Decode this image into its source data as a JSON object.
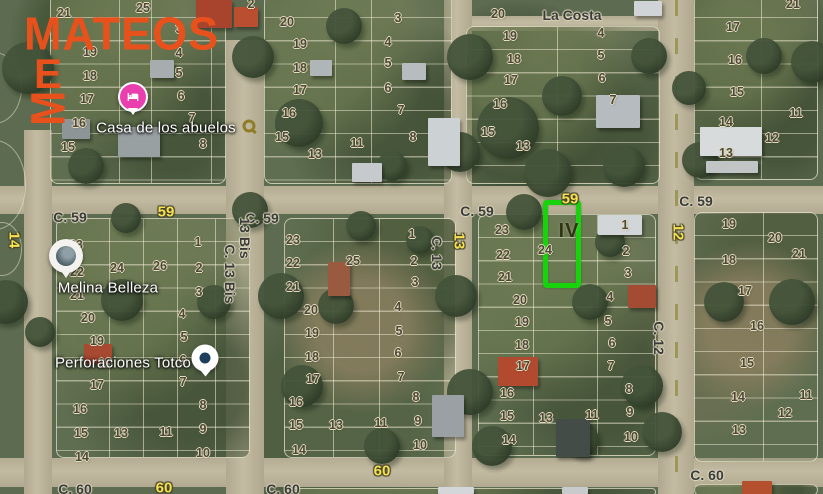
{
  "brand": {
    "name": "MATEOS",
    "color": "#e8511c",
    "mark_letters": [
      "E",
      "M"
    ]
  },
  "map": {
    "street_names": [
      {
        "t": "La Costa",
        "x": 572,
        "y": 15
      },
      {
        "t": "C. 59",
        "x": 70,
        "y": 217
      },
      {
        "t": "C. 59",
        "x": 262,
        "y": 218
      },
      {
        "t": "C. 59",
        "x": 477,
        "y": 211
      },
      {
        "t": "C. 59",
        "x": 696,
        "y": 201
      },
      {
        "t": "C. 60",
        "x": 75,
        "y": 489
      },
      {
        "t": "C. 60",
        "x": 283,
        "y": 489
      },
      {
        "t": "C. 60",
        "x": 707,
        "y": 475
      },
      {
        "t": "13 Bis",
        "x": 245,
        "y": 238,
        "v": 1
      },
      {
        "t": "C. 13 Bis",
        "x": 230,
        "y": 274,
        "v": 1
      },
      {
        "t": "C. 13",
        "x": 437,
        "y": 253,
        "v": 1
      },
      {
        "t": "C. 12",
        "x": 659,
        "y": 338,
        "v": 1
      }
    ],
    "route_badges": [
      {
        "t": "59",
        "x": 166,
        "y": 212
      },
      {
        "t": "59",
        "x": 570,
        "y": 199
      },
      {
        "t": "60",
        "x": 164,
        "y": 488
      },
      {
        "t": "60",
        "x": 382,
        "y": 471
      },
      {
        "t": "14",
        "x": 14,
        "y": 240,
        "v": 1
      },
      {
        "t": "13",
        "x": 459,
        "y": 241,
        "v": 1
      },
      {
        "t": "12",
        "x": 678,
        "y": 232,
        "v": 1
      }
    ],
    "blocks": [
      {
        "id": "northwest",
        "lots": [
          {
            "t": "21",
            "x": 64,
            "y": 13
          },
          {
            "t": "25",
            "x": 143,
            "y": 8
          },
          {
            "t": "2",
            "x": 251,
            "y": 4
          },
          {
            "t": "19",
            "x": 90,
            "y": 52
          },
          {
            "t": "18",
            "x": 90,
            "y": 76
          },
          {
            "t": "17",
            "x": 87,
            "y": 99
          },
          {
            "t": "16",
            "x": 79,
            "y": 123
          },
          {
            "t": "15",
            "x": 68,
            "y": 147
          },
          {
            "t": "3",
            "x": 179,
            "y": 29
          },
          {
            "t": "4",
            "x": 179,
            "y": 53
          },
          {
            "t": "5",
            "x": 179,
            "y": 73
          },
          {
            "t": "6",
            "x": 181,
            "y": 96
          },
          {
            "t": "7",
            "x": 192,
            "y": 118
          },
          {
            "t": "8",
            "x": 203,
            "y": 144
          }
        ]
      },
      {
        "id": "north-middle",
        "lots": [
          {
            "t": "20",
            "x": 287,
            "y": 22
          },
          {
            "t": "19",
            "x": 300,
            "y": 44
          },
          {
            "t": "18",
            "x": 300,
            "y": 68
          },
          {
            "t": "17",
            "x": 300,
            "y": 90
          },
          {
            "t": "16",
            "x": 289,
            "y": 113
          },
          {
            "t": "15",
            "x": 282,
            "y": 137
          },
          {
            "t": "13",
            "x": 315,
            "y": 154
          },
          {
            "t": "3",
            "x": 398,
            "y": 18
          },
          {
            "t": "4",
            "x": 388,
            "y": 42
          },
          {
            "t": "5",
            "x": 388,
            "y": 63
          },
          {
            "t": "6",
            "x": 388,
            "y": 88
          },
          {
            "t": "7",
            "x": 401,
            "y": 110
          },
          {
            "t": "8",
            "x": 413,
            "y": 137
          },
          {
            "t": "11",
            "x": 357,
            "y": 143
          }
        ]
      },
      {
        "id": "northeast",
        "lots": [
          {
            "t": "20",
            "x": 498,
            "y": 14
          },
          {
            "t": "19",
            "x": 510,
            "y": 36
          },
          {
            "t": "18",
            "x": 514,
            "y": 59
          },
          {
            "t": "17",
            "x": 511,
            "y": 80
          },
          {
            "t": "16",
            "x": 500,
            "y": 104
          },
          {
            "t": "15",
            "x": 488,
            "y": 132
          },
          {
            "t": "13",
            "x": 523,
            "y": 146
          },
          {
            "t": "4",
            "x": 601,
            "y": 33
          },
          {
            "t": "5",
            "x": 601,
            "y": 55
          },
          {
            "t": "6",
            "x": 602,
            "y": 78
          },
          {
            "t": "7",
            "x": 613,
            "y": 100
          }
        ]
      },
      {
        "id": "far-northeast",
        "lots": [
          {
            "t": "21",
            "x": 793,
            "y": 4
          },
          {
            "t": "17",
            "x": 733,
            "y": 27
          },
          {
            "t": "16",
            "x": 735,
            "y": 60
          },
          {
            "t": "15",
            "x": 737,
            "y": 92
          },
          {
            "t": "14",
            "x": 726,
            "y": 122
          },
          {
            "t": "13",
            "x": 726,
            "y": 153
          },
          {
            "t": "11",
            "x": 796,
            "y": 113
          },
          {
            "t": "12",
            "x": 772,
            "y": 138
          }
        ]
      },
      {
        "id": "west-middle",
        "lots": [
          {
            "t": "23",
            "x": 76,
            "y": 245
          },
          {
            "t": "22",
            "x": 77,
            "y": 272
          },
          {
            "t": "21",
            "x": 77,
            "y": 295
          },
          {
            "t": "20",
            "x": 88,
            "y": 318
          },
          {
            "t": "19",
            "x": 97,
            "y": 341
          },
          {
            "t": "18",
            "x": 105,
            "y": 363
          },
          {
            "t": "17",
            "x": 97,
            "y": 385
          },
          {
            "t": "16",
            "x": 80,
            "y": 409
          },
          {
            "t": "15",
            "x": 81,
            "y": 433
          },
          {
            "t": "14",
            "x": 82,
            "y": 457
          },
          {
            "t": "24",
            "x": 117,
            "y": 268
          },
          {
            "t": "26",
            "x": 160,
            "y": 266
          },
          {
            "t": "13",
            "x": 121,
            "y": 433
          },
          {
            "t": "11",
            "x": 166,
            "y": 432
          },
          {
            "t": "1",
            "x": 198,
            "y": 242
          },
          {
            "t": "2",
            "x": 199,
            "y": 268
          },
          {
            "t": "3",
            "x": 199,
            "y": 292
          },
          {
            "t": "4",
            "x": 182,
            "y": 314
          },
          {
            "t": "5",
            "x": 184,
            "y": 337
          },
          {
            "t": "6",
            "x": 183,
            "y": 360
          },
          {
            "t": "7",
            "x": 183,
            "y": 382
          },
          {
            "t": "8",
            "x": 203,
            "y": 405
          },
          {
            "t": "9",
            "x": 203,
            "y": 429
          },
          {
            "t": "10",
            "x": 203,
            "y": 453
          }
        ]
      },
      {
        "id": "middle",
        "lots": [
          {
            "t": "23",
            "x": 293,
            "y": 240
          },
          {
            "t": "22",
            "x": 293,
            "y": 263
          },
          {
            "t": "21",
            "x": 293,
            "y": 287
          },
          {
            "t": "20",
            "x": 311,
            "y": 310
          },
          {
            "t": "19",
            "x": 312,
            "y": 333
          },
          {
            "t": "18",
            "x": 312,
            "y": 357
          },
          {
            "t": "17",
            "x": 313,
            "y": 379
          },
          {
            "t": "16",
            "x": 296,
            "y": 402
          },
          {
            "t": "15",
            "x": 296,
            "y": 425
          },
          {
            "t": "14",
            "x": 299,
            "y": 450
          },
          {
            "t": "25",
            "x": 353,
            "y": 261
          },
          {
            "t": "13",
            "x": 336,
            "y": 425
          },
          {
            "t": "11",
            "x": 381,
            "y": 423
          },
          {
            "t": "1",
            "x": 412,
            "y": 234
          },
          {
            "t": "2",
            "x": 414,
            "y": 261
          },
          {
            "t": "3",
            "x": 415,
            "y": 282
          },
          {
            "t": "4",
            "x": 398,
            "y": 307
          },
          {
            "t": "5",
            "x": 399,
            "y": 331
          },
          {
            "t": "6",
            "x": 398,
            "y": 353
          },
          {
            "t": "7",
            "x": 401,
            "y": 377
          },
          {
            "t": "8",
            "x": 416,
            "y": 397
          },
          {
            "t": "9",
            "x": 418,
            "y": 421
          },
          {
            "t": "10",
            "x": 420,
            "y": 445
          }
        ]
      },
      {
        "id": "east-middle",
        "lots": [
          {
            "t": "23",
            "x": 502,
            "y": 230
          },
          {
            "t": "22",
            "x": 503,
            "y": 255
          },
          {
            "t": "21",
            "x": 505,
            "y": 277
          },
          {
            "t": "20",
            "x": 520,
            "y": 300
          },
          {
            "t": "19",
            "x": 522,
            "y": 322
          },
          {
            "t": "18",
            "x": 522,
            "y": 345
          },
          {
            "t": "17",
            "x": 523,
            "y": 366
          },
          {
            "t": "16",
            "x": 507,
            "y": 393
          },
          {
            "t": "15",
            "x": 507,
            "y": 416
          },
          {
            "t": "14",
            "x": 509,
            "y": 440
          },
          {
            "t": "24",
            "x": 545,
            "y": 250
          },
          {
            "t": "13",
            "x": 546,
            "y": 418
          },
          {
            "t": "11",
            "x": 592,
            "y": 415
          },
          {
            "t": "1",
            "x": 625,
            "y": 225
          },
          {
            "t": "2",
            "x": 626,
            "y": 251
          },
          {
            "t": "3",
            "x": 628,
            "y": 273
          },
          {
            "t": "4",
            "x": 610,
            "y": 297
          },
          {
            "t": "5",
            "x": 608,
            "y": 321
          },
          {
            "t": "6",
            "x": 612,
            "y": 343
          },
          {
            "t": "7",
            "x": 611,
            "y": 366
          },
          {
            "t": "8",
            "x": 629,
            "y": 389
          },
          {
            "t": "9",
            "x": 630,
            "y": 412
          },
          {
            "t": "10",
            "x": 631,
            "y": 437
          }
        ]
      },
      {
        "id": "far-east",
        "lots": [
          {
            "t": "19",
            "x": 729,
            "y": 224
          },
          {
            "t": "20",
            "x": 775,
            "y": 238
          },
          {
            "t": "21",
            "x": 799,
            "y": 254
          },
          {
            "t": "18",
            "x": 729,
            "y": 260
          },
          {
            "t": "17",
            "x": 745,
            "y": 291
          },
          {
            "t": "16",
            "x": 757,
            "y": 326
          },
          {
            "t": "15",
            "x": 747,
            "y": 363
          },
          {
            "t": "14",
            "x": 738,
            "y": 397
          },
          {
            "t": "13",
            "x": 739,
            "y": 430
          },
          {
            "t": "11",
            "x": 806,
            "y": 395
          },
          {
            "t": "12",
            "x": 785,
            "y": 413
          }
        ]
      }
    ],
    "pois": [
      {
        "name": "Casa de los abuelos",
        "lx": 166,
        "ly": 128,
        "px": 133,
        "py": 97,
        "pin": "lodging-pink"
      },
      {
        "name": "Melina Belleza",
        "lx": 108,
        "ly": 288,
        "px": 66,
        "py": 256,
        "pin": "white-circle-dark"
      },
      {
        "name": "Perforaciones Totco",
        "lx": 123,
        "ly": 363,
        "px": 205,
        "py": 358,
        "pin": "white-circle-navy-dot"
      }
    ],
    "highlight": {
      "label": "IV",
      "label_x": 569,
      "label_y": 231,
      "rect": {
        "left": 548,
        "top": 205,
        "width": 38,
        "height": 88
      },
      "color": "#16d30c"
    }
  }
}
